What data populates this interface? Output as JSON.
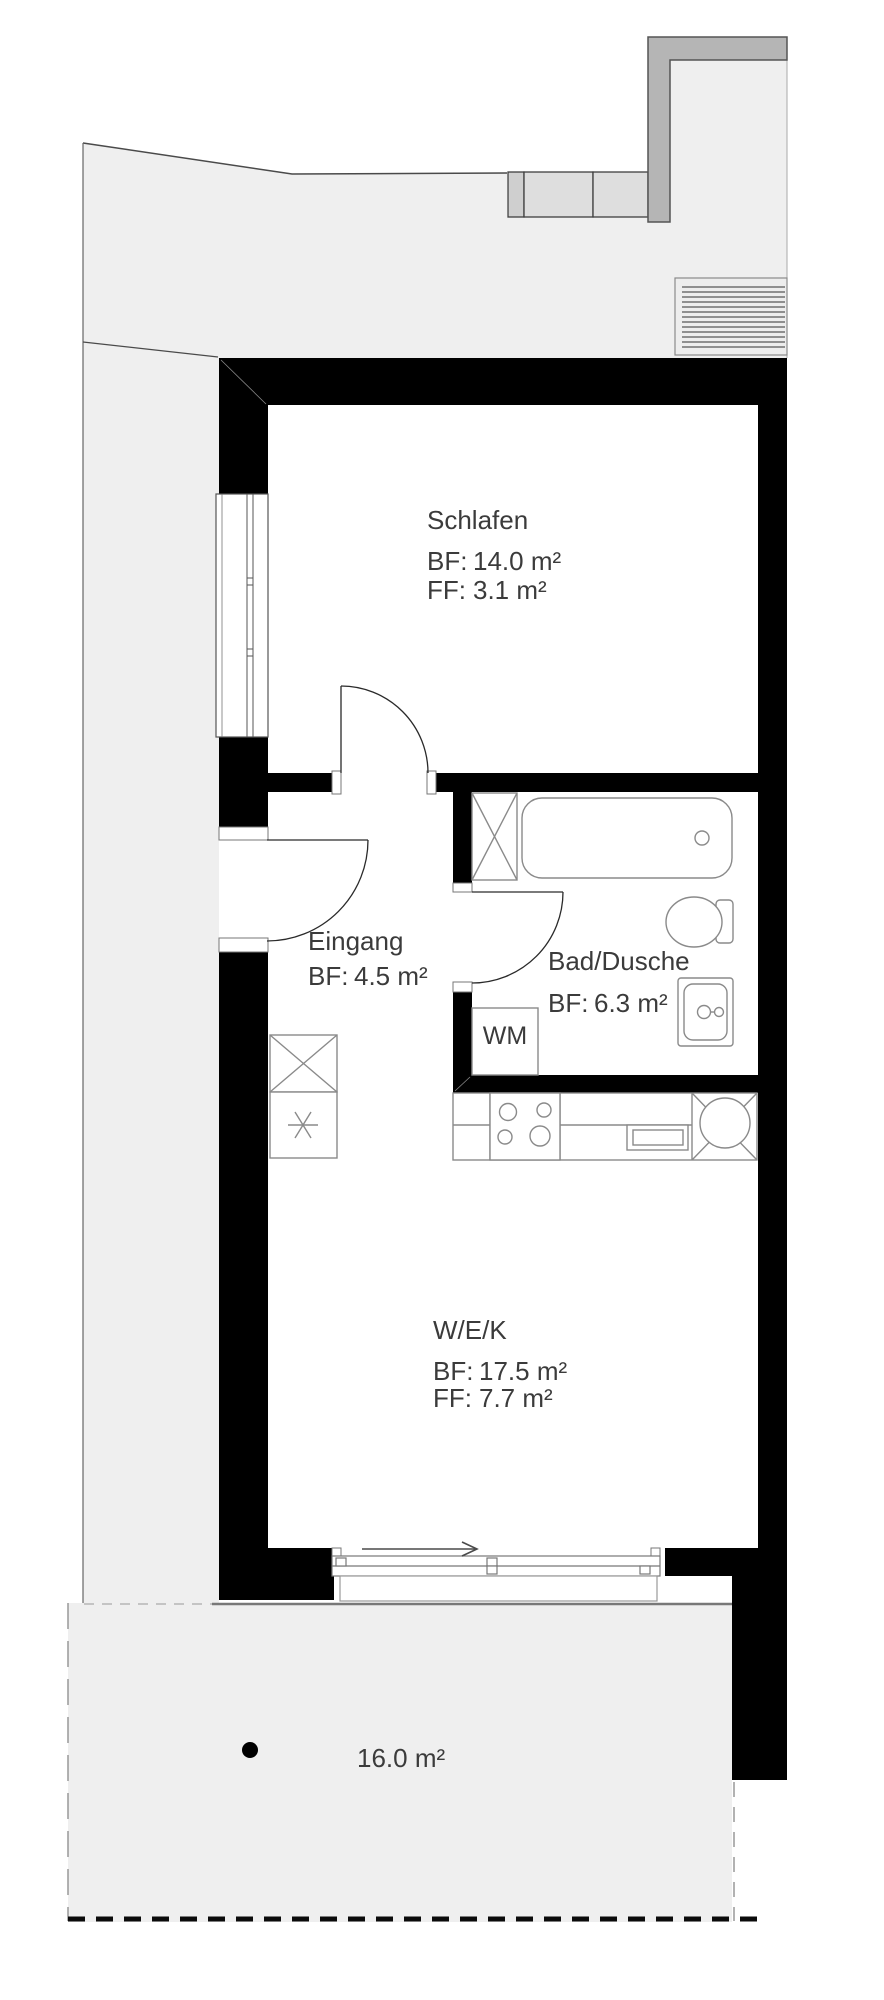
{
  "plan": {
    "rooms": [
      {
        "name": "Schlafen",
        "bf_label": "BF:",
        "bf_value": "14.0 m²",
        "ff_label": "FF:",
        "ff_value": "3.1 m²"
      },
      {
        "name": "Eingang",
        "bf_label": "BF:",
        "bf_value": "4.5 m²"
      },
      {
        "name": "Bad/Dusche",
        "bf_label": "BF:",
        "bf_value": "6.3 m²"
      },
      {
        "name": "W/E/K",
        "bf_label": "BF:",
        "bf_value": "17.5 m²",
        "ff_label": "FF:",
        "ff_value": "7.7 m²"
      }
    ],
    "appliances": {
      "washing_machine_label": "WM"
    },
    "terrace": {
      "area_label": "16.0 m²"
    },
    "icons": [
      "shaft-cross-icon",
      "bathtub-icon",
      "toilet-icon",
      "washbasin-icon",
      "stove-icon",
      "kitchen-sink-icon",
      "tall-cabinet-cross-icon",
      "freezer-star-icon",
      "sliding-door-arrow-icon",
      "terrace-dot-icon"
    ],
    "colors": {
      "wall": "#000000",
      "site_area": "#efefef",
      "fixture_stroke": "#8a8a8a",
      "text": "#3b3b3b",
      "parapet": "#b5b5b5",
      "terrace_edge": "#787878"
    }
  }
}
